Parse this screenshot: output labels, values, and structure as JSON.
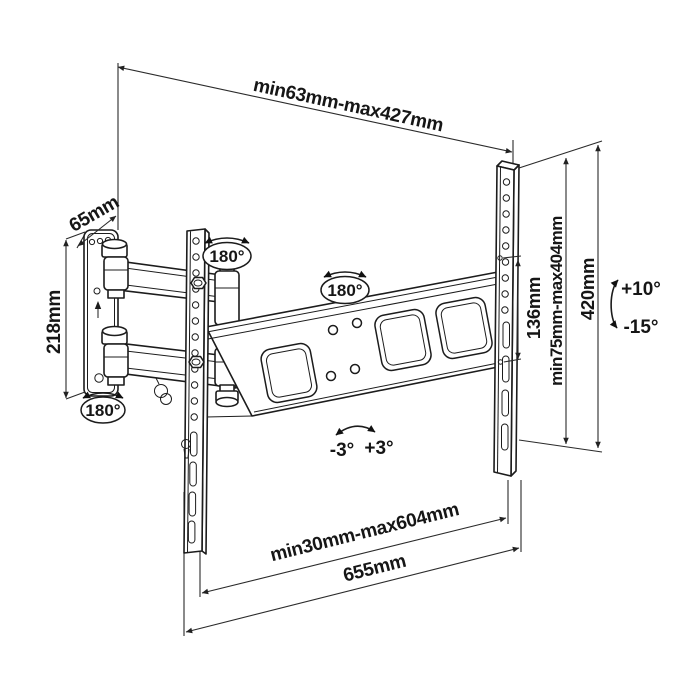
{
  "diagram": {
    "dimensions": {
      "depth_range": "min63mm-max427mm",
      "wall_plate_depth": "65mm",
      "wall_plate_height": "218mm",
      "hole_spacing": "136mm",
      "vertical_range": "min75mm-max404mm",
      "bracket_height": "420mm",
      "horizontal_range": "min30mm-max604mm",
      "overall_width": "655mm"
    },
    "angles": {
      "swivel_elbow": "180°",
      "swivel_beam": "180°",
      "swivel_plate": "180°",
      "tilt_up": "+10°",
      "tilt_down": "-15°",
      "level_left": "-3°",
      "level_right": "+3°"
    },
    "colors": {
      "line": "#1c1c1c",
      "background": "#ffffff"
    }
  }
}
